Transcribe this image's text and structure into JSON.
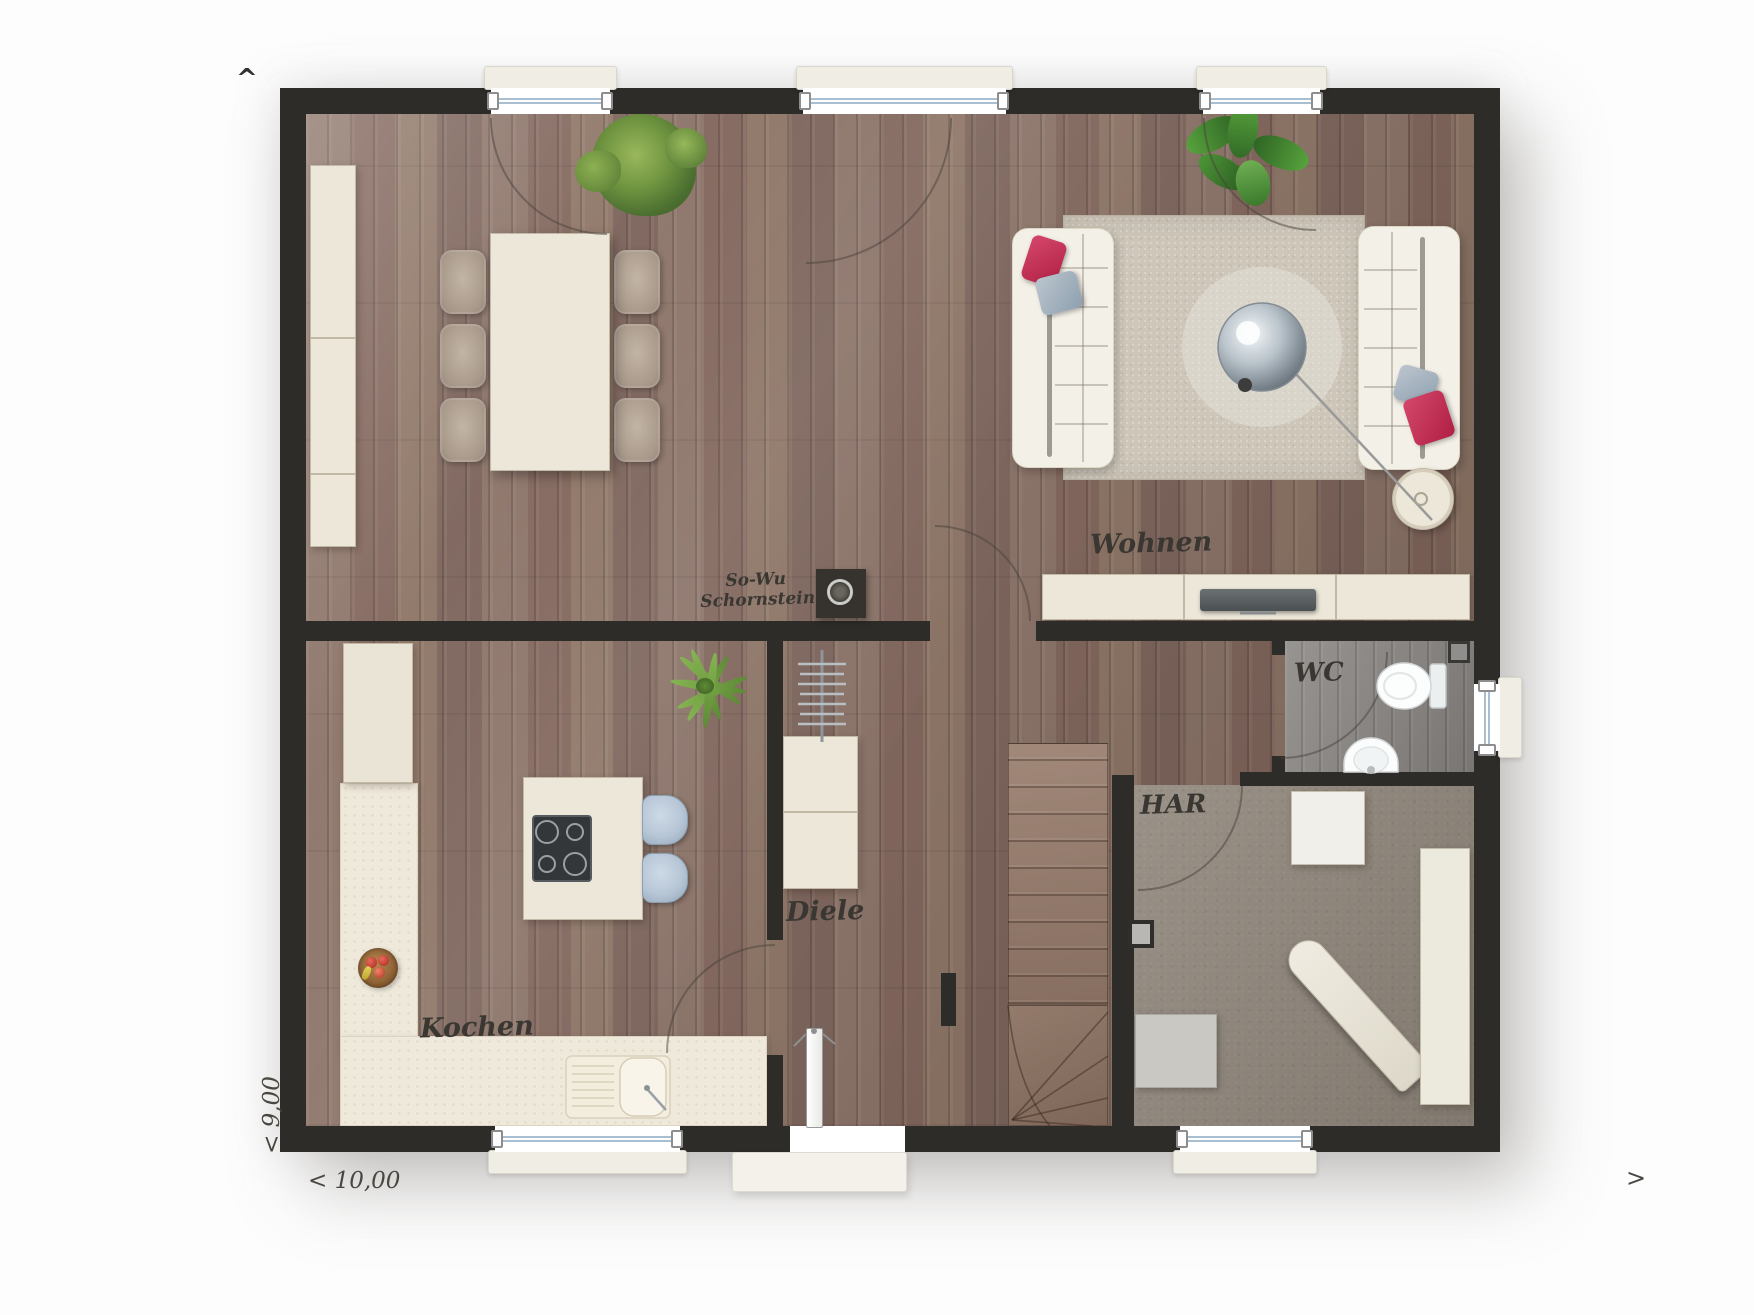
{
  "type": "floor-plan",
  "rooms": {
    "living": "Wohnen",
    "kitchen": "Kochen",
    "hall": "Diele",
    "wc": "WC",
    "utility": "HAR"
  },
  "annotations": {
    "chimney_line1": "So-Wu",
    "chimney_line2": "Schornstein"
  },
  "dimensions": {
    "width": "< 10,00",
    "height": "< 9,00",
    "east_arrow": ">",
    "north_arrow": "^"
  },
  "palette": {
    "wall": "#2e2c29",
    "wood_floor": "#8a7165",
    "furniture_cream": "#ece7d9",
    "rug": "#cdc6b9",
    "utility_carpet": "#958c81",
    "wc_floor": "#8d8a87",
    "pillow_red": "#c22a4e",
    "pillow_gray": "#9fb0bd",
    "stool_blue": "#b7c6d6",
    "plant_green": "#6f9440",
    "glass_line": "#a9bfd1"
  }
}
